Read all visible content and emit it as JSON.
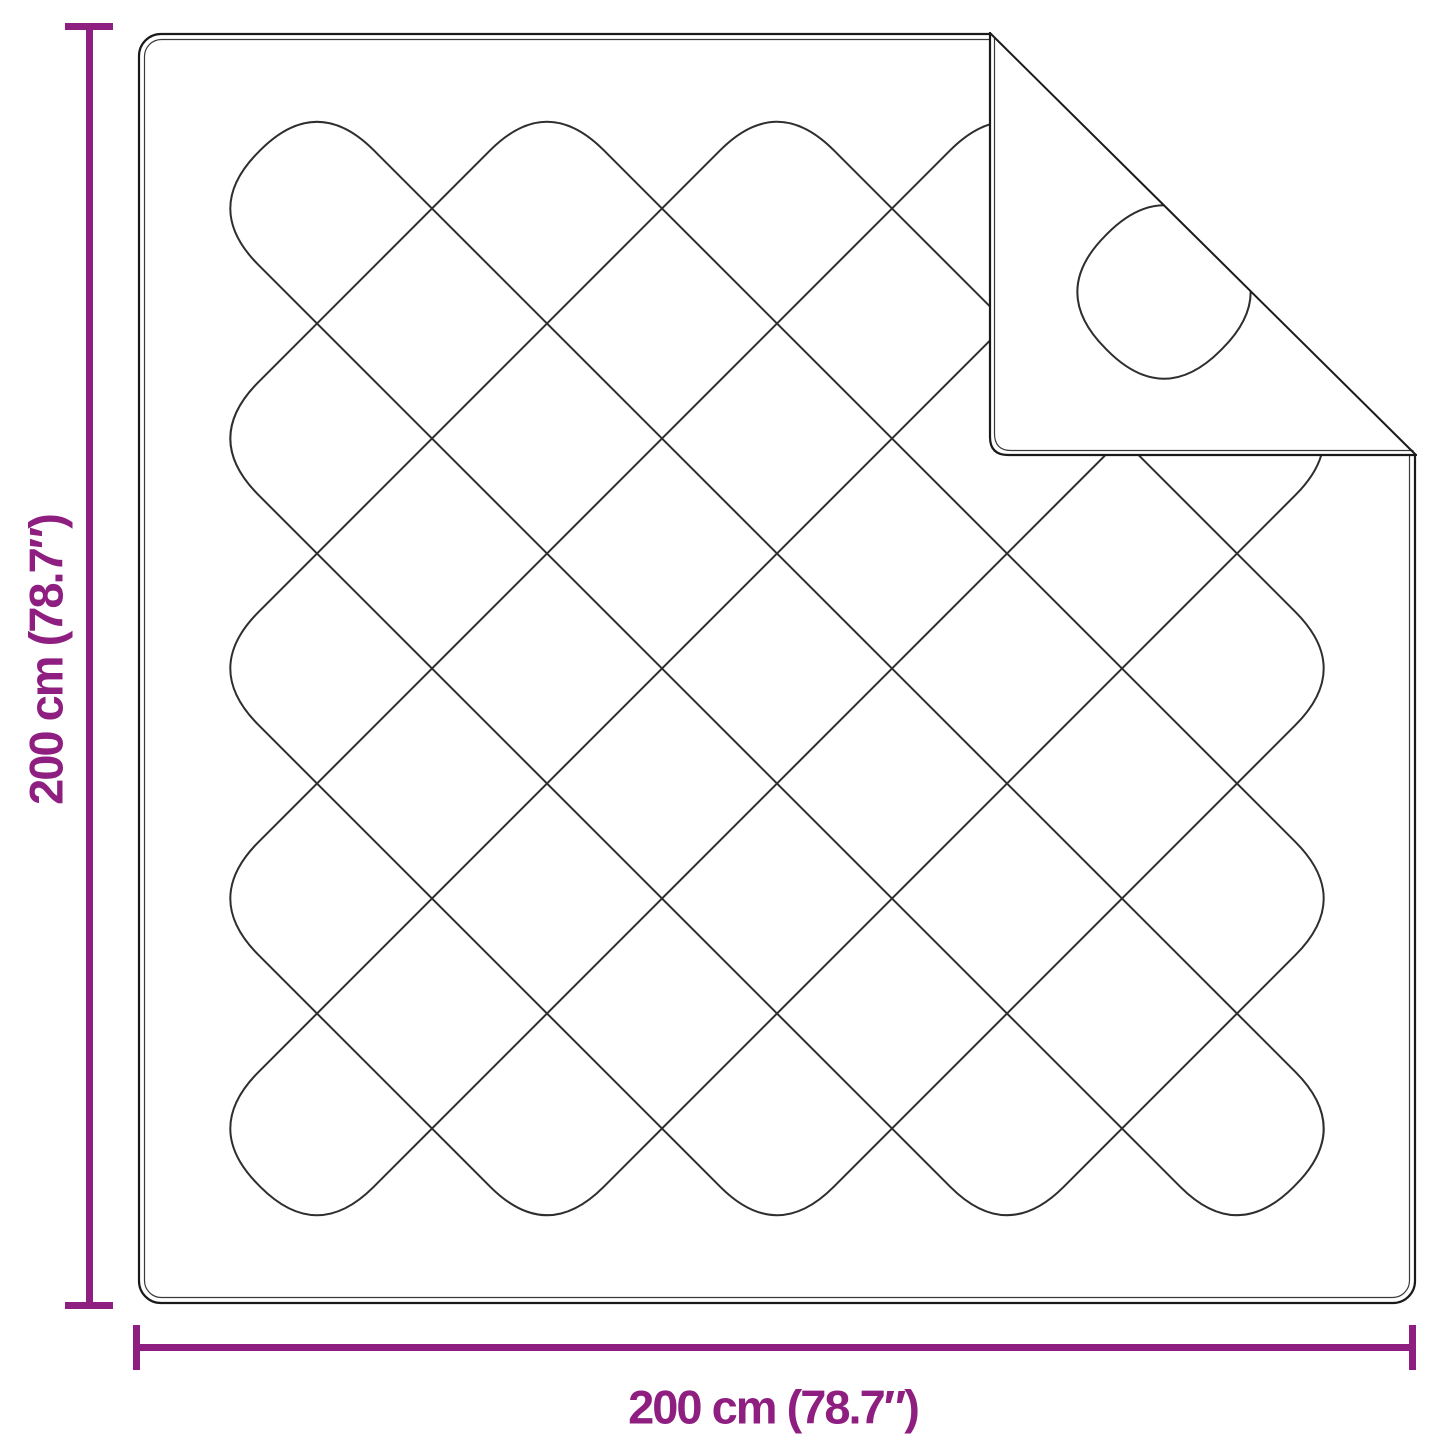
{
  "diagram": {
    "type": "product-dimension-diagram",
    "subject": "quilted-blanket-with-folded-corner",
    "vertical_dimension": {
      "label": "200 cm (78.7″)"
    },
    "horizontal_dimension": {
      "label": "200 cm (78.7″)"
    }
  },
  "colors": {
    "dimension_accent": "#8E1F80",
    "blanket_outline": "#1a1a1a",
    "blanket_outline_inner": "#3a3a3a",
    "quilt_stitch": "#2e2e2e",
    "background": "#ffffff"
  }
}
